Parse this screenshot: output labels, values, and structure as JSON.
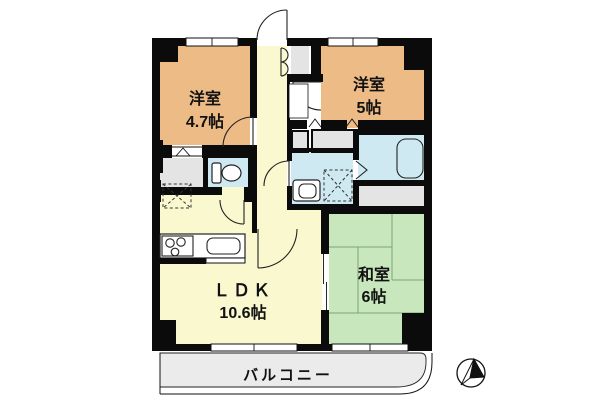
{
  "floorplan": {
    "rooms": [
      {
        "name": "洋室",
        "size": "4.7帖"
      },
      {
        "name": "洋室",
        "size": "5帖"
      },
      {
        "name": "ＬＤＫ",
        "size": "10.6帖"
      },
      {
        "name": "和室",
        "size": "6帖"
      }
    ],
    "balcony": {
      "label": "バルコニー"
    },
    "fixtures": [
      "entrance-door",
      "shoe-cabinet",
      "toilet",
      "washbasin",
      "washing-machine-space",
      "bathtub",
      "refrigerator-space",
      "stove",
      "kitchen-sink",
      "folding-bath-door",
      "north-arrow"
    ],
    "colors": {
      "western_room": "#edbb86",
      "ldk": "#f9f8cf",
      "tatami_room": "#c9e7bd",
      "wet_area": "#cfe9f2",
      "closet": "#e4e4e4",
      "balcony": "#ebebeb",
      "wall": "#0b0b0b"
    }
  }
}
